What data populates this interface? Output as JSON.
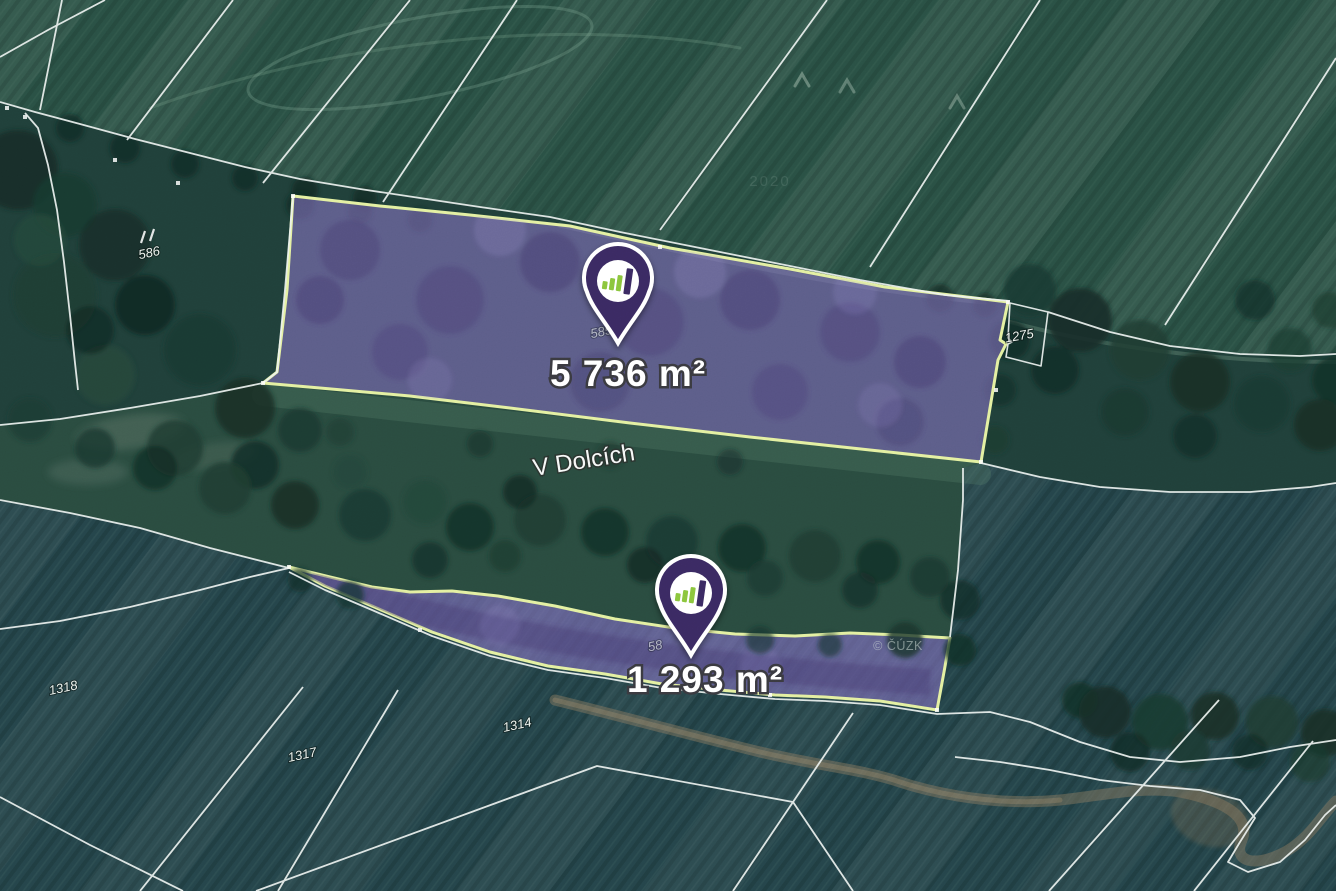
{
  "map": {
    "street_label": "V Dolcích",
    "copyright_watermark": "© ČÚZK",
    "imagery_watermark": "2020",
    "parcels": [
      {
        "name": "parcel-1",
        "area_label": "5 736 m²",
        "faint_number": "585"
      },
      {
        "name": "parcel-2",
        "area_label": "1 293 m²",
        "faint_number": "58"
      }
    ],
    "parcel_numbers": [
      {
        "id": "586",
        "label": "586"
      },
      {
        "id": "1275",
        "label": "1275"
      },
      {
        "id": "1318",
        "label": "1318"
      },
      {
        "id": "1317",
        "label": "1317"
      },
      {
        "id": "1314",
        "label": "1314"
      }
    ],
    "colors": {
      "parcel_fill": "#8a74c4",
      "parcel_border": "#e4f0a2",
      "cadastral_line": "#edf2f0",
      "pin": "#3b2c63",
      "pin_bar_green": "#8cc63e",
      "label_text": "#ffffff"
    }
  }
}
